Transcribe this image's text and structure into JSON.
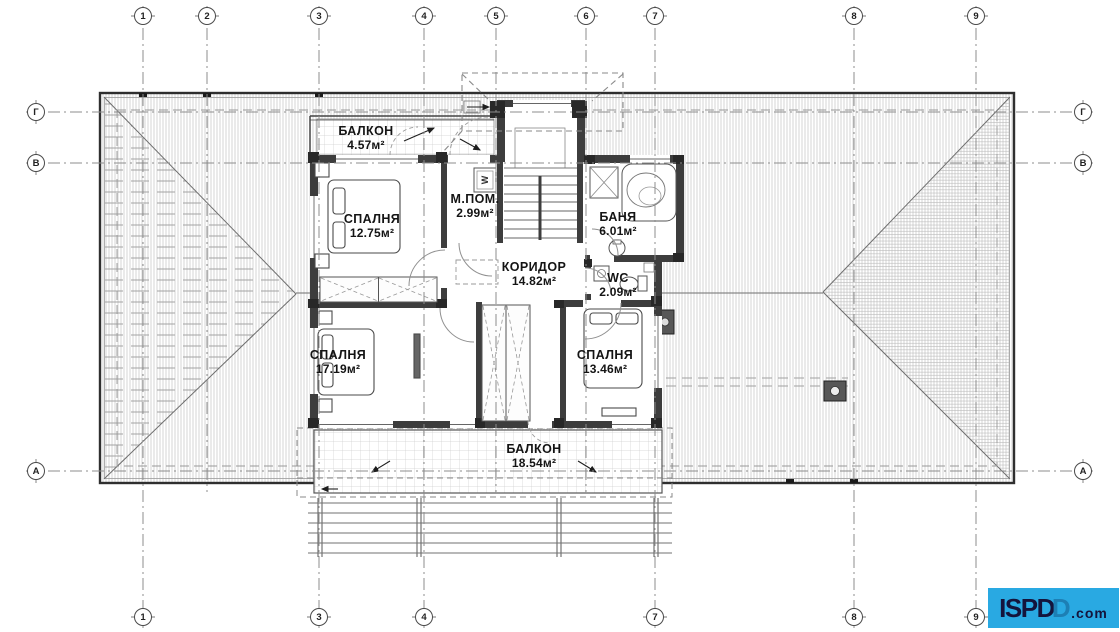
{
  "drawing": {
    "kind": "floor plan",
    "language": "Bulgarian"
  },
  "grid": {
    "top": [
      "1",
      "2",
      "3",
      "4",
      "5",
      "6",
      "7",
      "8",
      "9"
    ],
    "bottom": [
      "1",
      "3",
      "4",
      "7",
      "8",
      "9"
    ],
    "left": [
      "Г",
      "В",
      "А"
    ],
    "right": [
      "Г",
      "В",
      "А"
    ]
  },
  "rooms": [
    {
      "name": "БАЛКОН",
      "area": "4.57м²"
    },
    {
      "name": "СПАЛНЯ",
      "area": "12.75м²"
    },
    {
      "name": "М.ПОМ.",
      "area": "2.99м²"
    },
    {
      "name": "БАНЯ",
      "area": "6.01м²"
    },
    {
      "name": "КОРИДОР",
      "area": "14.82м²"
    },
    {
      "name": "WC",
      "area": "2.09м²"
    },
    {
      "name": "СПАЛНЯ",
      "area": "17.19м²"
    },
    {
      "name": "СПАЛНЯ",
      "area": "13.46м²"
    },
    {
      "name": "БАЛКОН",
      "area": "18.54м²"
    }
  ],
  "fixtures": {
    "washer_label": "W"
  },
  "logo": {
    "brand": "ISPD",
    "brand_outline_letter": "D",
    "suffix": ".com",
    "bg_color": "#29a9e2",
    "text_color": "#14143c"
  },
  "colors": {
    "wall": "#3d3d3d",
    "roof_hatch": "#c2c2c2",
    "grid_line": "#8c8c8c",
    "label_text": "#141414"
  }
}
